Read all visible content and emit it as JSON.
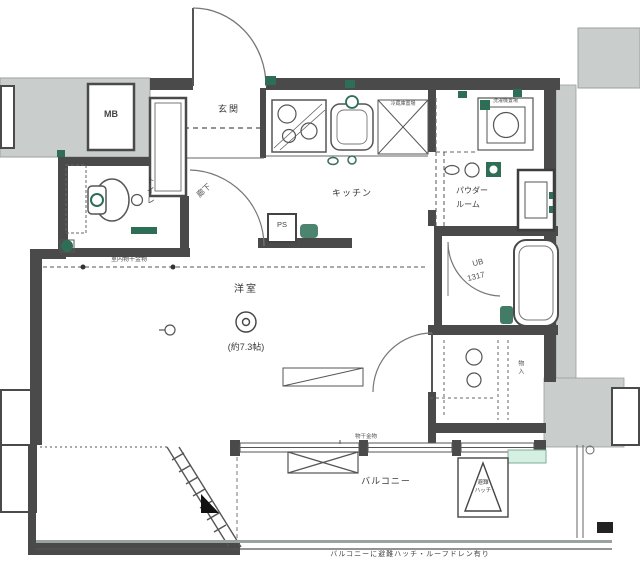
{
  "floorplan": {
    "labels": {
      "meter_box": "MB",
      "entrance": "玄関",
      "hallway": "廊下",
      "toilet": "トイレ",
      "kitchen": "キッチン",
      "pipe_space": "PS",
      "refrigerator_space": "冷蔵庫置場",
      "washer_space": "洗濯機置場",
      "powder_room_line1": "パウダー",
      "powder_room_line2": "ルーム",
      "unit_bath_line1": "UB",
      "unit_bath_line2": "1317",
      "main_room": "洋室",
      "main_room_size": "(約7.3帖)",
      "indoor_drying": "室内物干金物",
      "storage": "物入",
      "drying_bracket": "物干金物",
      "balcony": "バルコニー",
      "escape_hatch_line1": "避難",
      "escape_hatch_line2": "ハッチ",
      "footnote": "バルコニーに避難ハッチ・ルーフドレン有り"
    },
    "colors": {
      "wall": "#4a4a4a",
      "common_area_gray": "#c9cdcc",
      "symbol_green": "#2e6e56",
      "mint": "#d6efe3"
    }
  }
}
